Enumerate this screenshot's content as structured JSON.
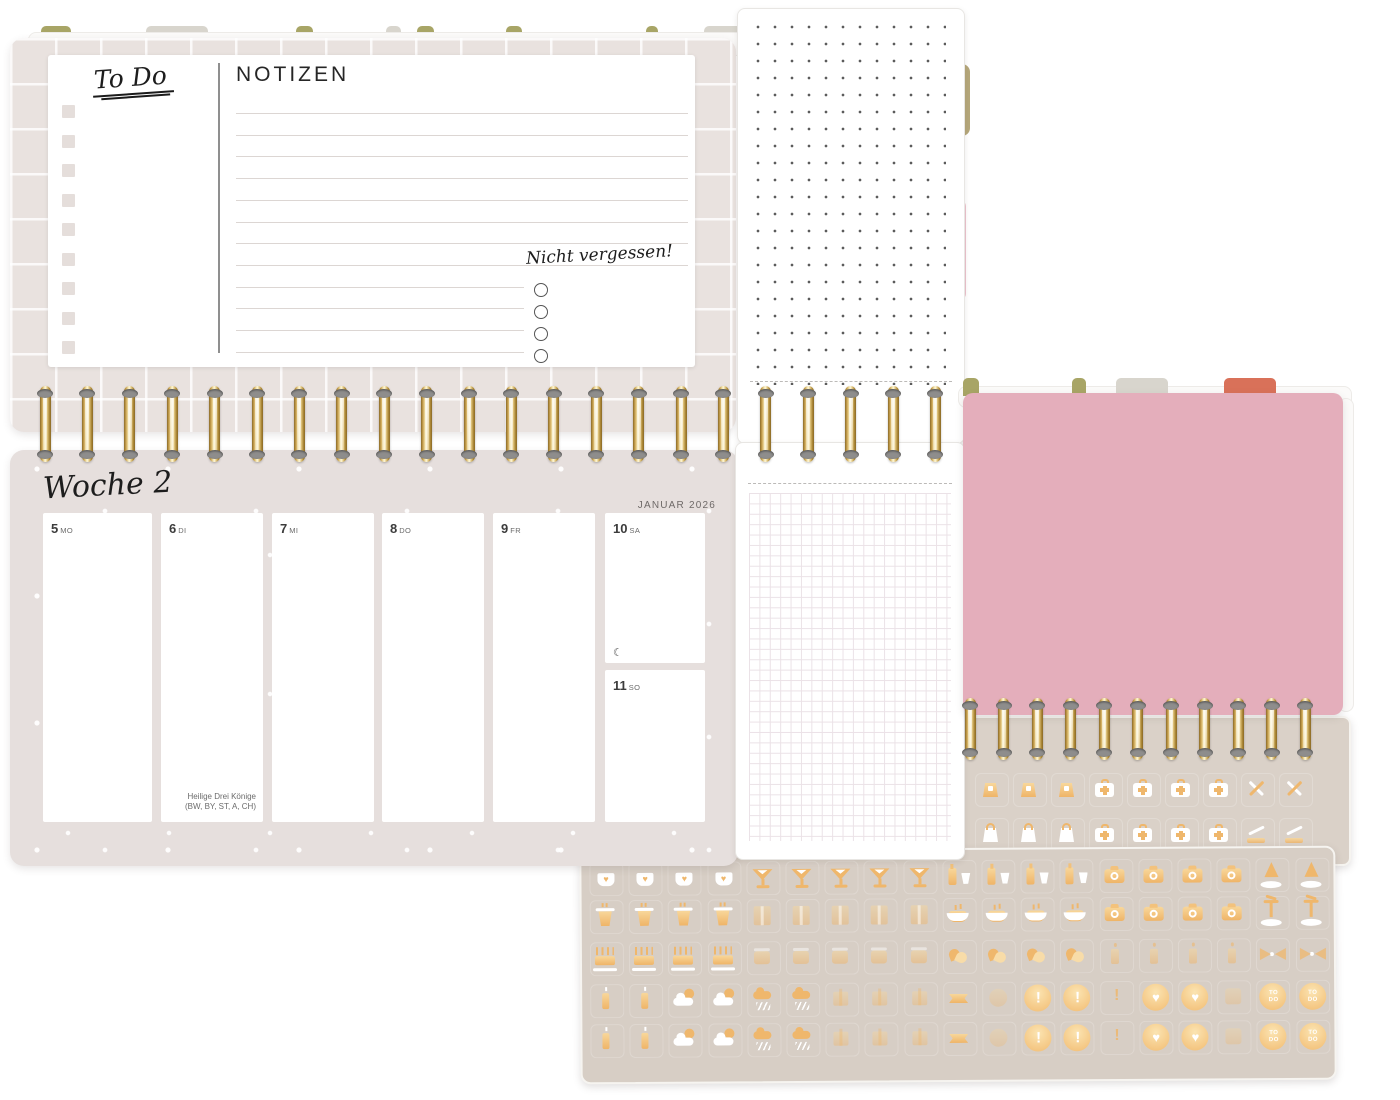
{
  "planner": {
    "todo_page": {
      "title": "To Do",
      "notes_heading": "NOTIZEN",
      "reminder_heading": "Nicht vergessen!"
    },
    "week_page": {
      "title": "Woche 2",
      "month": "JANUAR 2026",
      "days": [
        {
          "num": "5",
          "wd": "MO"
        },
        {
          "num": "6",
          "wd": "DI",
          "holiday": "Heilige Drei Könige",
          "holiday_regions": "(BW, BY, ST, A, CH)"
        },
        {
          "num": "7",
          "wd": "MI"
        },
        {
          "num": "8",
          "wd": "DO"
        },
        {
          "num": "9",
          "wd": "FR"
        },
        {
          "num": "10",
          "wd": "SA",
          "moon": "☾"
        }
      ],
      "sunday": {
        "num": "11",
        "wd": "SO"
      }
    }
  },
  "colors": {
    "gold": "#EFB76C",
    "pink_divider": "#E4AEBB",
    "tab_olive": "#A8A566",
    "tab_gray": "#D8D5CD",
    "tab_red": "#D97159",
    "sheet_beige": "#D7CEC5",
    "page_beige": "#E6DFDD"
  },
  "stickers": {
    "glyphs": {
      "excl": "!",
      "heart": "♥",
      "todo": "TO\nDO"
    },
    "front_rows": [
      [
        "mug",
        "mug",
        "mug",
        "mug",
        "martini",
        "martini",
        "martini",
        "martini",
        "martini",
        "champagne",
        "champagne",
        "champagne",
        "champagne",
        "camera",
        "camera",
        "camera",
        "camera",
        "tree",
        "tree"
      ],
      [
        "cup",
        "cup",
        "cup",
        "cup",
        "giftwrap",
        "giftwrap",
        "giftwrap",
        "giftwrap",
        "giftwrap",
        "bowl",
        "bowl",
        "bowl",
        "bowl",
        "camera",
        "camera",
        "camera",
        "camera",
        "palm",
        "palm"
      ],
      [
        "cake",
        "cake",
        "cake",
        "cake",
        "roundcake",
        "roundcake",
        "roundcake",
        "roundcake",
        "roundcake",
        "handheart",
        "handheart",
        "handheart",
        "handheart",
        "candle",
        "candle",
        "candle",
        "candle",
        "bow",
        "bow"
      ],
      [
        "candles2",
        "candles2",
        "cloudsun",
        "cloudsun",
        "raincloud",
        "raincloud",
        "giftfaint",
        "giftfaint",
        "giftfaint",
        "flagbow",
        "faintcircle",
        "exclcircle",
        "exclcircle",
        "exclthin",
        "heartcircle",
        "heartcircle",
        "faintsquare",
        "todocircle",
        "todocircle"
      ],
      [
        "candles2",
        "candles2",
        "cloudsun",
        "cloudsun",
        "raincloud",
        "raincloud",
        "giftfaint",
        "giftfaint",
        "giftfaint",
        "flagbow",
        "faintcircle",
        "exclcircle",
        "exclcircle",
        "exclthin",
        "heartcircle",
        "heartcircle",
        "faintsquare",
        "todocircle",
        "todocircle"
      ]
    ],
    "back_rows": [
      [
        "bag",
        "bag",
        "bag",
        "medkit",
        "medkit",
        "medkit",
        "medkit",
        "toolsx",
        "toolsx"
      ],
      [
        "bagfull",
        "bagfull",
        "bagfull",
        "medkit",
        "medkit",
        "medkit",
        "medkit",
        "bonesaw",
        "bonesaw"
      ]
    ]
  },
  "layout": {
    "todo_checkboxes": 9,
    "notizen_lines": {
      "count": 12,
      "short_from": 8,
      "step": 21.7,
      "top": 58
    },
    "reminder_circles": 4,
    "rings_top": {
      "count": 22,
      "x0": 45,
      "dx": 42.4,
      "y": 386,
      "h": 76
    },
    "rings_pink": {
      "count": 11,
      "x0": 970,
      "dx": 33.5,
      "y": 698,
      "h": 62
    },
    "tabs_top": [
      {
        "x": 41,
        "w": 30,
        "c": "olive"
      },
      {
        "x": 146,
        "w": 62,
        "c": "gray"
      },
      {
        "x": 296,
        "w": 17,
        "c": "olive"
      },
      {
        "x": 386,
        "w": 15,
        "c": "gray"
      },
      {
        "x": 417,
        "w": 17,
        "c": "olive"
      },
      {
        "x": 506,
        "w": 16,
        "c": "olive"
      },
      {
        "x": 646,
        "w": 12,
        "c": "olive"
      },
      {
        "x": 704,
        "w": 42,
        "c": "gray"
      },
      {
        "x": 764,
        "w": 44,
        "c": "gray"
      },
      {
        "x": 844,
        "w": 56,
        "c": "red"
      }
    ],
    "tabs_pink": [
      {
        "x": 963,
        "w": 16,
        "c": "olive"
      },
      {
        "x": 1072,
        "w": 14,
        "c": "olive"
      },
      {
        "x": 1116,
        "w": 52,
        "c": "gray"
      },
      {
        "x": 1224,
        "w": 52,
        "c": "red"
      }
    ],
    "front_sheet": {
      "x0": 25,
      "dx": 39.2,
      "rows_y": [
        27,
        65,
        107,
        149,
        189
      ]
    },
    "back_sheet": {
      "x0": 27,
      "dx": 38,
      "rows_y": [
        72,
        117
      ]
    }
  }
}
